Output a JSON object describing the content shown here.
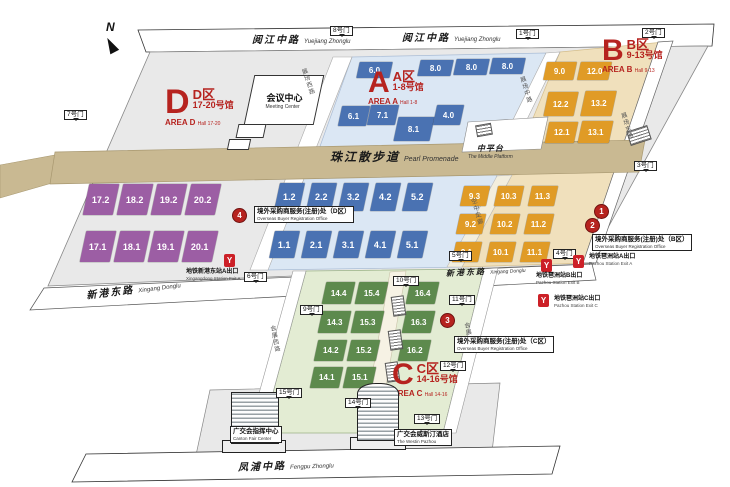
{
  "compass": {
    "label": "N"
  },
  "roads": {
    "yuejiang": {
      "cn": "阅江中路",
      "en": "Yuejiang Zhonglu"
    },
    "promenade": {
      "cn": "珠江散步道",
      "en": "Pearl Promenade"
    },
    "middle_platform": {
      "cn": "中平台",
      "en": "The Middle Platform"
    },
    "xingang": {
      "cn": "新港东路",
      "en": "Xingang Donglu"
    },
    "fengpu": {
      "cn": "凤浦中路",
      "en": "Fengpu Zhonglu"
    },
    "zhanchang_xi": {
      "cn": "展场西路"
    },
    "zhanchang_zhong": {
      "cn": "展场中路"
    },
    "zhanchang_dong": {
      "cn": "展场东路"
    },
    "air_corridor": {
      "cn": "空中走廊"
    },
    "huizhan_xi": {
      "cn": "会展西路"
    },
    "huizhan_dong": {
      "cn": "会展东路"
    }
  },
  "areas": {
    "a": {
      "letter": "A",
      "cn": "A区",
      "halls_cn": "1-8号馆",
      "en": "AREA A",
      "halls_en": "Hall 1-8"
    },
    "b": {
      "letter": "B",
      "cn": "B区",
      "halls_cn": "9-13号馆",
      "en": "AREA B",
      "halls_en": "Hall 9-13"
    },
    "c": {
      "letter": "C",
      "cn": "C区",
      "halls_cn": "14-16号馆",
      "en": "AREA C",
      "halls_en": "Hall 14-16"
    },
    "d": {
      "letter": "D",
      "cn": "D区",
      "halls_cn": "17-20号馆",
      "en": "AREA D",
      "halls_en": "Hall 17-20"
    }
  },
  "halls": {
    "d": [
      "17.2",
      "18.2",
      "19.2",
      "20.2",
      "17.1",
      "18.1",
      "19.1",
      "20.1"
    ],
    "a_north": [
      "6.0",
      "8.0",
      "8.0",
      "8.0",
      "6.1",
      "7.1",
      "8.1",
      "4.0"
    ],
    "a_south": [
      "1.2",
      "2.2",
      "3.2",
      "4.2",
      "5.2",
      "1.1",
      "2.1",
      "3.1",
      "4.1",
      "5.1"
    ],
    "b_north": [
      "9.0",
      "12.0",
      "12.2",
      "13.2",
      "12.1",
      "13.1"
    ],
    "b_south": [
      "9.3",
      "10.3",
      "11.3",
      "9.2",
      "10.2",
      "11.2",
      "9.1",
      "10.1",
      "11.1"
    ],
    "c": [
      "14.4",
      "15.4",
      "16.4",
      "14.3",
      "15.3",
      "16.3",
      "14.2",
      "15.2",
      "16.2",
      "14.1",
      "15.1"
    ]
  },
  "gates": [
    "7号门",
    "8号门",
    "1号门",
    "2号门",
    "3号门",
    "5号门",
    "4号门",
    "6号门",
    "9号门",
    "10号门",
    "11号门",
    "12号门",
    "13号门",
    "14号门",
    "15号门"
  ],
  "buildings": {
    "meeting_center": {
      "cn": "会议中心",
      "en": "Meeting Center"
    },
    "canton_fair_center": {
      "cn": "广交会指挥中心",
      "en": "Canton Fair Center"
    },
    "westin": {
      "cn": "广交会威斯汀酒店",
      "en": "The Westin Pazhou"
    }
  },
  "markers": {
    "reg_d": {
      "num": "4",
      "cn": "境外采购商服务(注册)处（D区）",
      "en": "Overseas Buyer Registration Office"
    },
    "reg_b": {
      "nums": [
        "1",
        "2"
      ],
      "cn": "境外采购商服务(注册)处（B区）",
      "en": "Overseas Buyer Registration Office"
    },
    "reg_c": {
      "num": "3",
      "cn": "境外采购商服务(注册)处（C区）",
      "en": "Overseas Buyer Registration Office"
    }
  },
  "metro": [
    {
      "cn": "地铁新港东站A出口",
      "en": "Xingangdong Station Exit A"
    },
    {
      "cn": "地铁琶洲站B出口",
      "en": "Pazhou Station Exit B"
    },
    {
      "cn": "地铁琶洲站A出口",
      "en": "Pazhou Station Exit A"
    },
    {
      "cn": "地铁琶洲站C出口",
      "en": "Pazhou Station Exit C"
    }
  ],
  "colors": {
    "accent_red": "#b6231f",
    "metro_red": "#cc2027",
    "hall_a": "#4a72b2",
    "hall_b": "#e09b26",
    "hall_c": "#5d8a4d",
    "hall_d": "#9c5ea4"
  }
}
